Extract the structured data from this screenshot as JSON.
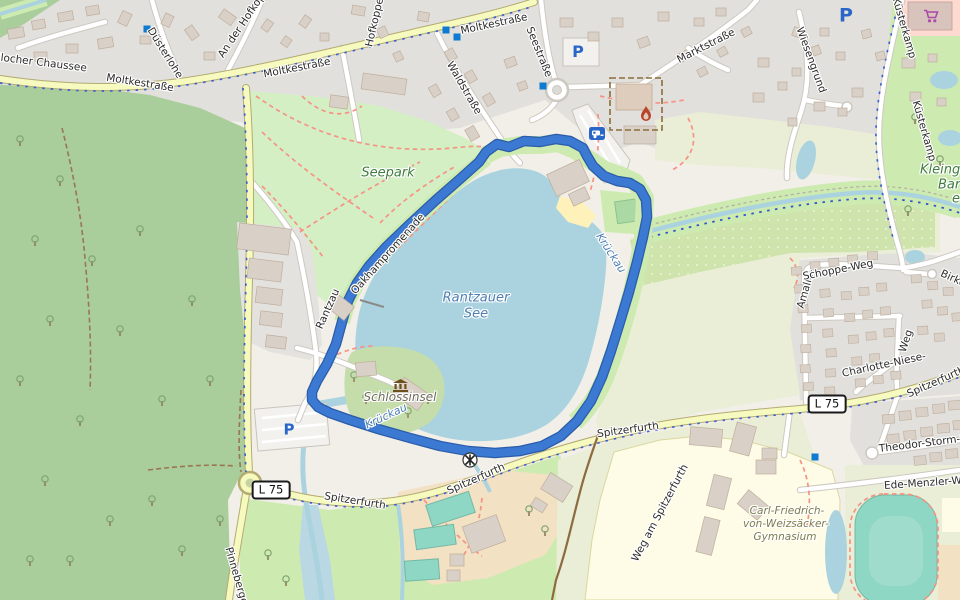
{
  "map": {
    "streets": {
      "chaussee": "ßlocher Chaussee",
      "moltkestrasse": "Moltkestraße",
      "duesterlohe": "Düsterlohe",
      "an_der_hofkoppel": "An der Hofkoppel",
      "hofkoppel": "Hofkoppel",
      "waldstrasse": "Waldstraße",
      "seestrasse": "Seestraße",
      "marktstrasse": "Marktstraße",
      "wiesengrund": "Wiesengrund",
      "kuesterkamp": "Küsterkamp",
      "oakhampromenade": "Oakhampromenade",
      "rantzau": "Rantzau",
      "spitzerfurth": "Spitzerfurth",
      "weg_am_spitzerfurth": "Weg am Spitzerfurth",
      "pinneberger": "Pinneberger",
      "amalie": "Amalie-",
      "schoppe_weg": "Schoppe-Weg",
      "charlotte_niese": "Charlotte-Niese-",
      "weg_suffix": "Weg",
      "birkenweg": "Birke",
      "theodor_storm": "Theodor-Storm-Straße",
      "ede_menzler_weg": "Ede-Menzler-Weg"
    },
    "places": {
      "seepark": "Seepark",
      "rantzauer_see_line1": "Rantzauer",
      "rantzauer_see_line2": "See",
      "schlossinsel": "Schlossinsel",
      "krueckau": "Krückau",
      "gymnasium_line1": "Carl-Friedrich-",
      "gymnasium_line2": "von-Weizsäcker-",
      "gymnasium_line3": "Gymnasium",
      "kleingarten_line1": "Kleingär",
      "kleingarten_line2": "Barm",
      "kleingarten_line3": "e"
    },
    "road_ref": {
      "l75": "L 75"
    },
    "parking_symbol": "P",
    "icons": [
      "parking-icon",
      "caravan-site-icon",
      "fire-station-icon",
      "museum-icon",
      "weir-icon",
      "supermarket-cart-icon",
      "bus-stop-marker"
    ],
    "colors": {
      "route": "#3c79d2",
      "route_casing": "#2a5ca9",
      "water": "#aad3df",
      "forest": "#a9cd9b",
      "park": "#d5efc5",
      "grass": "#cdebb0",
      "field": "#eaeed6",
      "residential": "#e1e0dc",
      "road_secondary": "#f7fabf",
      "building": "#d9d0c8",
      "school_area": "#fefce6",
      "pitch": "#8ed7c4",
      "path_dashed": "#f59384",
      "parking_blue": "#2a66c8"
    }
  }
}
